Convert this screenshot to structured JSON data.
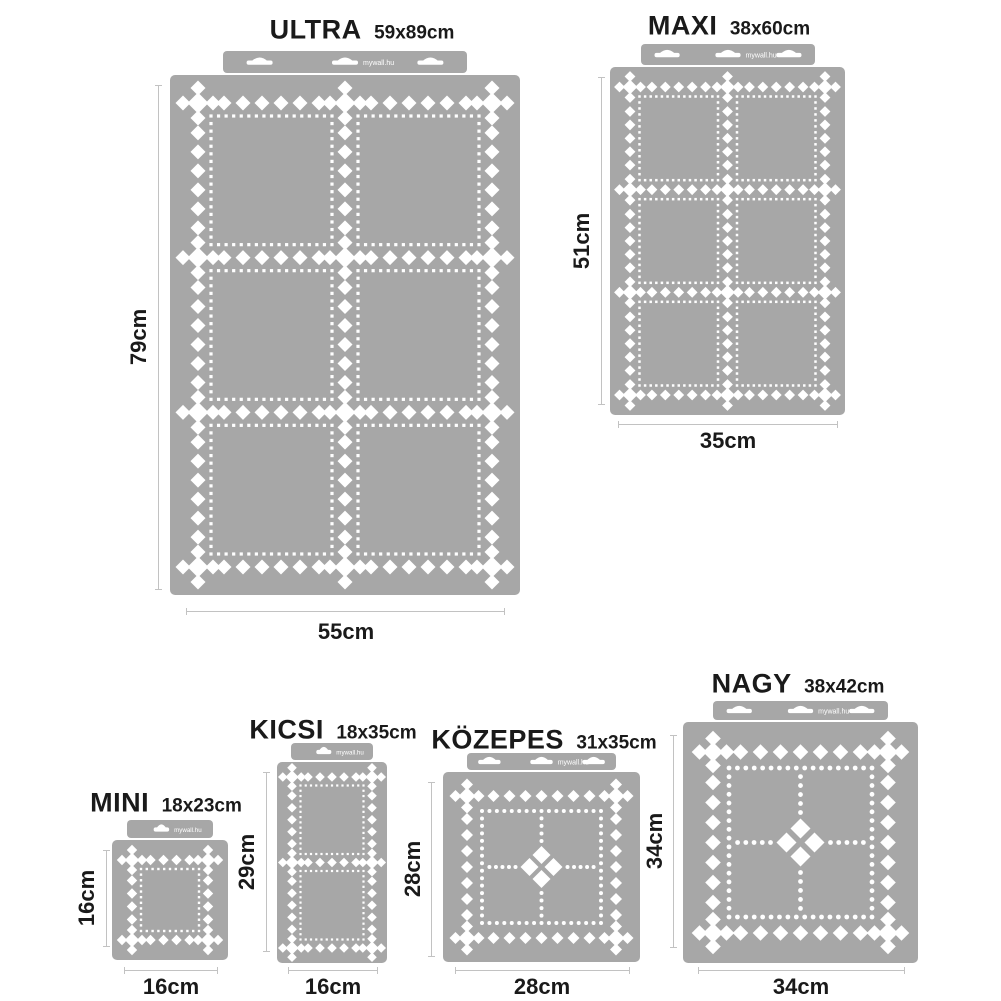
{
  "page": {
    "background": "#ffffff",
    "brand": "mywall.hu"
  },
  "colors": {
    "stencil_gray": "#a7a7a7",
    "cutout_white": "#ffffff",
    "dimension_line": "#c2c2c2",
    "text": "#1a1a1a"
  },
  "stencils": [
    {
      "id": "ultra",
      "name": "ULTRA",
      "size_label": "59x89cm",
      "height_label": "79cm",
      "width_label": "55cm",
      "pattern": "grid",
      "grid": {
        "cols": 2,
        "rows": 3
      },
      "frames": 6,
      "hanger_slots": 3
    },
    {
      "id": "maxi",
      "name": "MAXI",
      "size_label": "38x60cm",
      "height_label": "51cm",
      "width_label": "35cm",
      "pattern": "grid",
      "grid": {
        "cols": 2,
        "rows": 3
      },
      "frames": 6,
      "hanger_slots": 3
    },
    {
      "id": "mini",
      "name": "MINI",
      "size_label": "18x23cm",
      "height_label": "16cm",
      "width_label": "16cm",
      "pattern": "grid",
      "grid": {
        "cols": 1,
        "rows": 1
      },
      "frames": 1,
      "hanger_slots": 1
    },
    {
      "id": "kicsi",
      "name": "KICSI",
      "size_label": "18x35cm",
      "height_label": "29cm",
      "width_label": "16cm",
      "pattern": "grid",
      "grid": {
        "cols": 1,
        "rows": 2
      },
      "frames": 2,
      "hanger_slots": 1
    },
    {
      "id": "kozepes",
      "name": "KÖZEPES",
      "size_label": "31x35cm",
      "height_label": "28cm",
      "width_label": "28cm",
      "pattern": "quad",
      "frames": 4,
      "hanger_slots": 3
    },
    {
      "id": "nagy",
      "name": "NAGY",
      "size_label": "38x42cm",
      "height_label": "34cm",
      "width_label": "34cm",
      "pattern": "quad",
      "frames": 4,
      "hanger_slots": 3
    }
  ]
}
